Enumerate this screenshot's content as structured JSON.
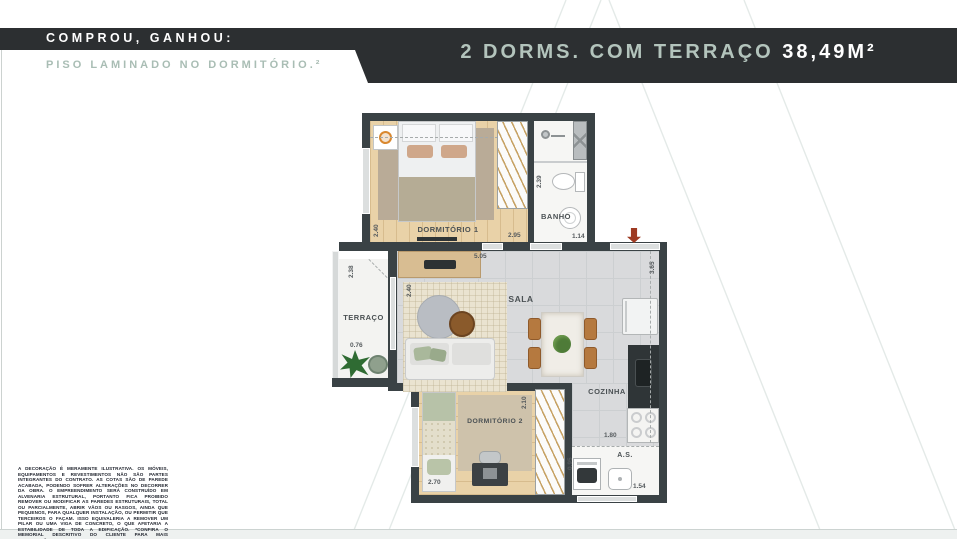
{
  "promo": {
    "line1": "COMPROU, GANHOU:",
    "line2": "PISO LAMINADO NO DORMITÓRIO.²"
  },
  "header": {
    "title": "2 DORMS. COM TERRAÇO",
    "area": "38,49M²"
  },
  "colors": {
    "ribbon_dark": "#2c2f31",
    "accent_green": "#a9bdb4",
    "wall_dark": "#3a4245",
    "entry_arrow_red": "#9e3a22"
  },
  "plan": {
    "rooms": {
      "dorm1": {
        "label": "DORMITÓRIO 1",
        "dim_w": "2.95",
        "dim_h": "2.40"
      },
      "banho": {
        "label": "BANHO",
        "dim_w": "1.14",
        "dim_h": "2.39"
      },
      "terraco": {
        "label": "TERRAÇO",
        "dim_w": "0.76",
        "dim_h": "2.38"
      },
      "sala": {
        "label": "SALA",
        "dim_w": "5.05",
        "dim_h": "2.40"
      },
      "cozinha": {
        "label": "COZINHA",
        "dim_w": "1.80",
        "dim_h": "3.65"
      },
      "dorm2": {
        "label": "DORMITÓRIO 2",
        "dim_w": "2.70",
        "dim_h": "2.10"
      },
      "as": {
        "label": "A.S.",
        "dim_w": "1.54",
        "dim_h": "0.95"
      }
    }
  },
  "disclaimer": "A DECORAÇÃO É MERAMENTE ILUSTRATIVA. OS MÓVEIS, EQUIPAMENTOS E REVESTIMENTOS NÃO SÃO PARTES INTEGRANTES DO CONTRATO. AS COTAS SÃO DE PAREDE ACABADA, PODENDO SOFRER ALTERAÇÕES NO DECORRER DA OBRA. O EMPREENDIMENTO SERÁ CONSTRUÍDO EM ALVENARIA ESTRUTURAL, PORTANTO FICA PROIBIDO REMOVER OU MODIFICAR AS PAREDES ESTRUTURAIS, TOTAL OU PARCIALMENTE, ABRIR VÃOS OU RASGOS, AINDA QUE PEQUENOS, PARA QUALQUER INSTALAÇÃO, OU PERMITIR QUE TERCEIROS O FAÇAM. ISSO EQUIVALERIA A REMOVER UM PILAR OU UMA VIGA DE CONCRETO, O QUE AFETARIA A ESTABILIDADE DE TODA A EDIFICAÇÃO. *CONFIRA O MEMORIAL DESCRITIVO DO CLIENTE PARA MAIS INFORMAÇÕES."
}
